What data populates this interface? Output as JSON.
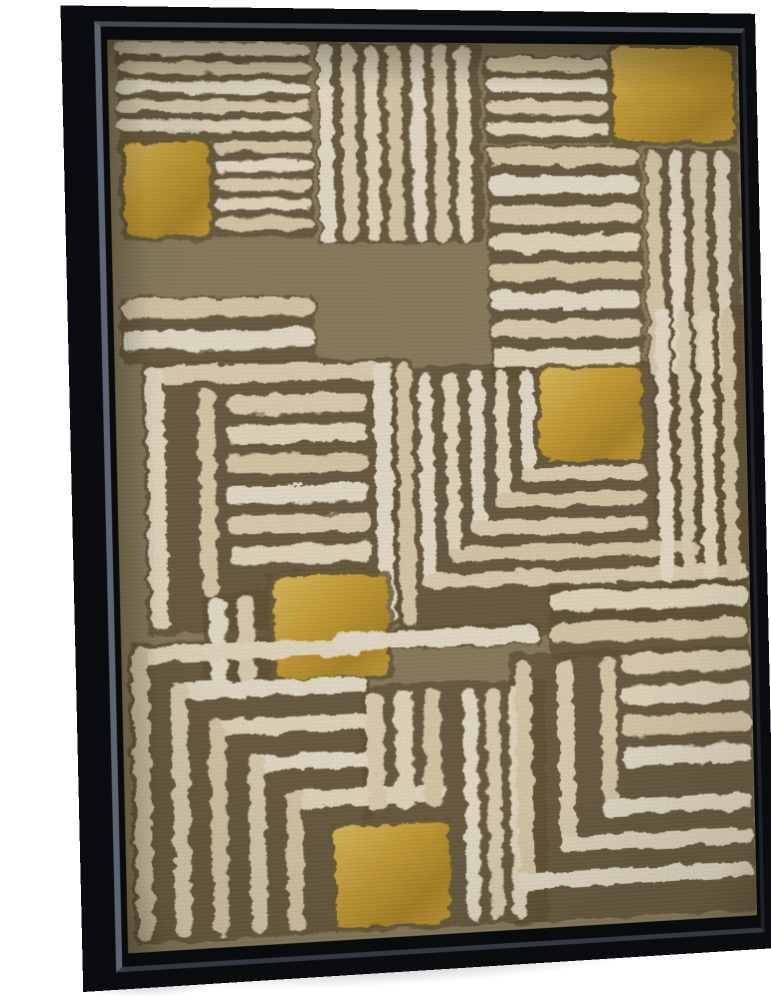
{
  "scene": {
    "background": "#ffffff",
    "subject": "abstract geometric line painting on canvas in a black floating frame, angled product view"
  },
  "frame": {
    "face_color": "#121318",
    "outer_edge_color": "#0b0c0f",
    "lip_left_color": "#5d6472",
    "lip_top_color": "#454b55",
    "well_color": "#0a0b0d"
  },
  "artwork": {
    "field_color": "#8b7d5e",
    "field_light": "#97896a",
    "gap_color": "#5a4c31",
    "stripe_tones": [
      "#eee4cb",
      "#e2d3b2",
      "#f1e9d5",
      "#e7d9bd"
    ],
    "gold": {
      "light": "#e7c45e",
      "base": "#cfa332",
      "dark": "#b38823"
    },
    "gold_edge": "#6b5b35",
    "underlays": [
      {
        "x": 8,
        "y": 2,
        "w": 190,
        "h": 94
      },
      {
        "x": 10,
        "y": 96,
        "w": 90,
        "h": 100
      },
      {
        "x": 100,
        "y": 96,
        "w": 100,
        "h": 98
      },
      {
        "x": 204,
        "y": 0,
        "w": 166,
        "h": 200
      },
      {
        "x": 374,
        "y": 12,
        "w": 130,
        "h": 88
      },
      {
        "x": 374,
        "y": 102,
        "w": 160,
        "h": 236
      },
      {
        "x": 504,
        "y": 0,
        "w": 134,
        "h": 102
      },
      {
        "x": 538,
        "y": 106,
        "w": 100,
        "h": 232
      },
      {
        "x": 6,
        "y": 250,
        "w": 192,
        "h": 66
      },
      {
        "x": 26,
        "y": 314,
        "w": 250,
        "h": 266
      },
      {
        "x": 274,
        "y": 314,
        "w": 22,
        "h": 268
      },
      {
        "x": 296,
        "y": 322,
        "w": 344,
        "h": 274
      },
      {
        "x": 428,
        "y": 548,
        "w": 210,
        "h": 72
      },
      {
        "x": 542,
        "y": 264,
        "w": 100,
        "h": 286
      },
      {
        "x": 144,
        "y": 522,
        "w": 124,
        "h": 110
      },
      {
        "x": 80,
        "y": 540,
        "w": 66,
        "h": 98
      },
      {
        "x": 6,
        "y": 588,
        "w": 240,
        "h": 294
      },
      {
        "x": 202,
        "y": 772,
        "w": 122,
        "h": 110
      },
      {
        "x": 206,
        "y": 581,
        "w": 214,
        "h": 24
      },
      {
        "x": 234,
        "y": 639,
        "w": 188,
        "h": 243
      },
      {
        "x": 386,
        "y": 612,
        "w": 254,
        "h": 272
      }
    ],
    "blocks": [
      {
        "t": "h",
        "x": 8,
        "y": 2,
        "w": 190,
        "h": 94,
        "n": 5
      },
      {
        "t": "gold",
        "x": 14,
        "y": 100,
        "w": 82,
        "h": 92
      },
      {
        "t": "h",
        "x": 102,
        "y": 98,
        "w": 96,
        "h": 94,
        "n": 5
      },
      {
        "t": "v",
        "x": 206,
        "y": 2,
        "w": 162,
        "h": 196,
        "n": 7
      },
      {
        "t": "h",
        "x": 376,
        "y": 14,
        "w": 126,
        "h": 86,
        "n": 4
      },
      {
        "t": "h",
        "x": 376,
        "y": 104,
        "w": 156,
        "h": 232,
        "n": 8
      },
      {
        "t": "gold",
        "x": 508,
        "y": 2,
        "w": 126,
        "h": 96
      },
      {
        "t": "v",
        "x": 540,
        "y": 108,
        "w": 96,
        "h": 228,
        "n": 4
      },
      {
        "t": "h",
        "x": 8,
        "y": 252,
        "w": 188,
        "h": 62,
        "n": 2
      },
      {
        "t": "bar",
        "x": 30,
        "y": 318,
        "w": 244,
        "h": 17
      },
      {
        "t": "bar",
        "x": 30,
        "y": 318,
        "w": 17,
        "h": 258
      },
      {
        "t": "bar",
        "x": 80,
        "y": 340,
        "w": 16,
        "h": 206
      },
      {
        "t": "bar",
        "x": 255,
        "y": 318,
        "w": 17,
        "h": 260
      },
      {
        "t": "h",
        "x": 108,
        "y": 348,
        "w": 140,
        "h": 178,
        "n": 6
      },
      {
        "t": "bar",
        "x": 278,
        "y": 318,
        "w": 15,
        "h": 262
      },
      {
        "t": "gold",
        "x": 424,
        "y": 328,
        "w": 106,
        "h": 92
      },
      {
        "t": "cnrbl",
        "x": 404,
        "yb": 440,
        "vl": 112,
        "hl": 130,
        "b": 14
      },
      {
        "t": "cnrbl",
        "x": 378,
        "yb": 466,
        "vl": 138,
        "hl": 156,
        "b": 14
      },
      {
        "t": "cnrbl",
        "x": 352,
        "yb": 492,
        "vl": 164,
        "hl": 182,
        "b": 14
      },
      {
        "t": "cnrbl",
        "x": 326,
        "yb": 518,
        "vl": 190,
        "hl": 262,
        "b": 14
      },
      {
        "t": "cnrbl",
        "x": 300,
        "yb": 544,
        "vl": 216,
        "hl": 338,
        "b": 14
      },
      {
        "t": "h",
        "x": 430,
        "y": 552,
        "w": 206,
        "h": 64,
        "n": 2
      },
      {
        "t": "v",
        "x": 546,
        "y": 268,
        "w": 92,
        "h": 278,
        "n": 4
      },
      {
        "t": "gold",
        "x": 150,
        "y": 528,
        "w": 114,
        "h": 100
      },
      {
        "t": "v",
        "x": 86,
        "y": 546,
        "w": 56,
        "h": 86,
        "n": 2
      },
      {
        "t": "cnrtl",
        "x": 10,
        "y": 592,
        "hl": 226,
        "vl": 286,
        "b": 16
      },
      {
        "t": "cnrtl",
        "x": 47,
        "y": 629,
        "hl": 196,
        "vl": 249,
        "b": 16
      },
      {
        "t": "cnrtl",
        "x": 84,
        "y": 666,
        "hl": 166,
        "vl": 212,
        "b": 16
      },
      {
        "t": "cnrtl",
        "x": 121,
        "y": 703,
        "hl": 136,
        "vl": 175,
        "b": 16
      },
      {
        "t": "cnrtl",
        "x": 158,
        "y": 740,
        "hl": 162,
        "vl": 138,
        "b": 16
      },
      {
        "t": "gold",
        "x": 206,
        "y": 778,
        "w": 114,
        "h": 100
      },
      {
        "t": "bar",
        "x": 210,
        "y": 585,
        "w": 208,
        "h": 18
      },
      {
        "t": "v",
        "x": 240,
        "y": 645,
        "w": 86,
        "h": 118,
        "n": 3
      },
      {
        "t": "v",
        "x": 338,
        "y": 645,
        "w": 70,
        "h": 233,
        "n": 3
      },
      {
        "t": "cnrbl",
        "x": 392,
        "yb": 850,
        "vl": 230,
        "hl": 246,
        "b": 16
      },
      {
        "t": "cnrbl",
        "x": 436,
        "yb": 815,
        "vl": 195,
        "hl": 202,
        "b": 16
      },
      {
        "t": "cnrbl",
        "x": 480,
        "yb": 780,
        "vl": 160,
        "hl": 158,
        "b": 16
      },
      {
        "t": "h",
        "x": 502,
        "y": 618,
        "w": 136,
        "h": 126,
        "n": 4
      }
    ]
  }
}
